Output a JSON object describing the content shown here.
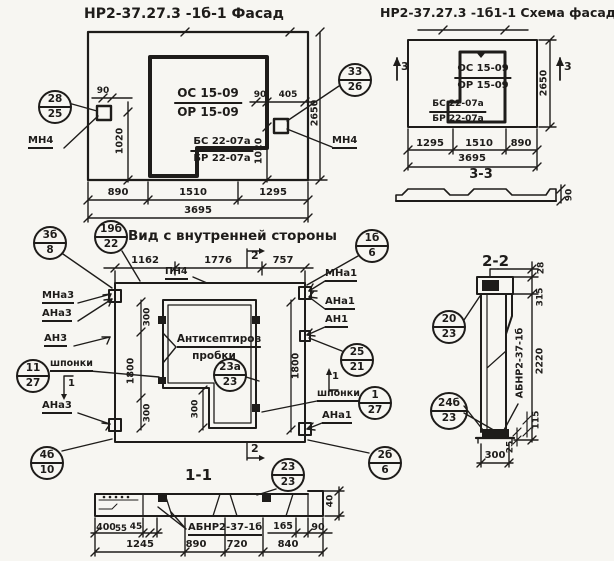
{
  "colors": {
    "ink": "#1e1c1a",
    "paper": "#f7f6f2"
  },
  "facade": {
    "title": "НР2-37.27.3 -1б-1 Фасад",
    "opening_num": "ОС 15-09",
    "opening_den": "ОР 15-09",
    "beam_num": "БС 22-07а",
    "beam_den": "БР 22-07а",
    "callout_left_num": "28",
    "callout_left_den": "25",
    "callout_right_num": "33",
    "callout_right_den": "26",
    "anchor_left": "МН4",
    "anchor_right": "МН4",
    "dim_90_left": "90",
    "dim_1020_left": "1020",
    "dim_90_right": "90",
    "dim_405": "405",
    "dim_1020_right": "1020",
    "dim_2650": "2650",
    "dim_890": "890",
    "dim_1510": "1510",
    "dim_1295": "1295",
    "dim_3695": "3695"
  },
  "schema": {
    "title": "НР2-37.27.3 -1б1-1 Схема фасада",
    "mark_3_left": "3",
    "mark_3_right": "3",
    "opening_num": "ОС 15-09",
    "opening_den": "ОР 15-09",
    "beam_num": "БС 22-07а",
    "beam_den": "БР 22-07а",
    "dim_2650": "2650",
    "dim_1295": "1295",
    "dim_1510": "1510",
    "dim_890": "890",
    "dim_3695": "3695",
    "section_33_title": "3-3",
    "dim_90": "90"
  },
  "inner_view": {
    "title": "Вид с внутренней стороны",
    "callout_title_left_num": "19б",
    "callout_title_left_den": "22",
    "callout_title_right_num": "1б",
    "callout_title_right_den": "6",
    "dim_1162": "1162",
    "dim_1776": "1776",
    "dim_757": "757",
    "label_pn4": "ПН4",
    "mark_2_top": "2",
    "mark_2_bottom": "2",
    "mark_1_left": "1",
    "mark_1_right": "1",
    "label_mna3": "МНа3",
    "label_ana3": "АНа3",
    "label_an3": "АН3",
    "label_shponki_left": "шпонки",
    "label_ana3_2": "АНа3",
    "callout_3b8_num": "3б",
    "callout_3b8_den": "8",
    "callout_1127_num": "11",
    "callout_1127_den": "27",
    "callout_4b10_num": "4б",
    "callout_4b10_den": "10",
    "label_mna1": "МНа1",
    "label_ana1": "АНа1",
    "label_an1": "АН1",
    "label_shponki_right": "шпонки",
    "label_ana1_2": "АНа1",
    "callout_2521_num": "25",
    "callout_2521_den": "21",
    "callout_127_num": "1",
    "callout_127_den": "27",
    "callout_2b6_num": "2б",
    "callout_2b6_den": "6",
    "plugs_line1": "Антисептиров",
    "plugs_line2": "пробки",
    "callout_23a_num": "23а",
    "callout_23a_den": "23",
    "dim_1800_left": "1800",
    "dim_1800_right": "1800",
    "dim_300_top": "300",
    "dim_300_mid": "300",
    "dim_300_bottom": "300"
  },
  "section_11": {
    "title": "1-1",
    "callout_num": "23",
    "callout_den": "23",
    "label": "АБНР2-37-1б",
    "dim_400": "400",
    "dim_55": "55",
    "dim_45": "45",
    "dim_165": "165",
    "dim_90": "90",
    "dim_40": "40",
    "dim_1245": "1245",
    "dim_890": "890",
    "dim_720": "720",
    "dim_840": "840"
  },
  "section_22": {
    "title": "2-2",
    "callout_top_num": "20",
    "callout_top_den": "23",
    "callout_bottom_num": "24б",
    "callout_bottom_den": "23",
    "label_vertical": "АБНР2-37-1б",
    "dim_28": "28",
    "dim_315": "315",
    "dim_2220": "2220",
    "dim_115": "115",
    "dim_25": "25",
    "dim_300": "300"
  }
}
